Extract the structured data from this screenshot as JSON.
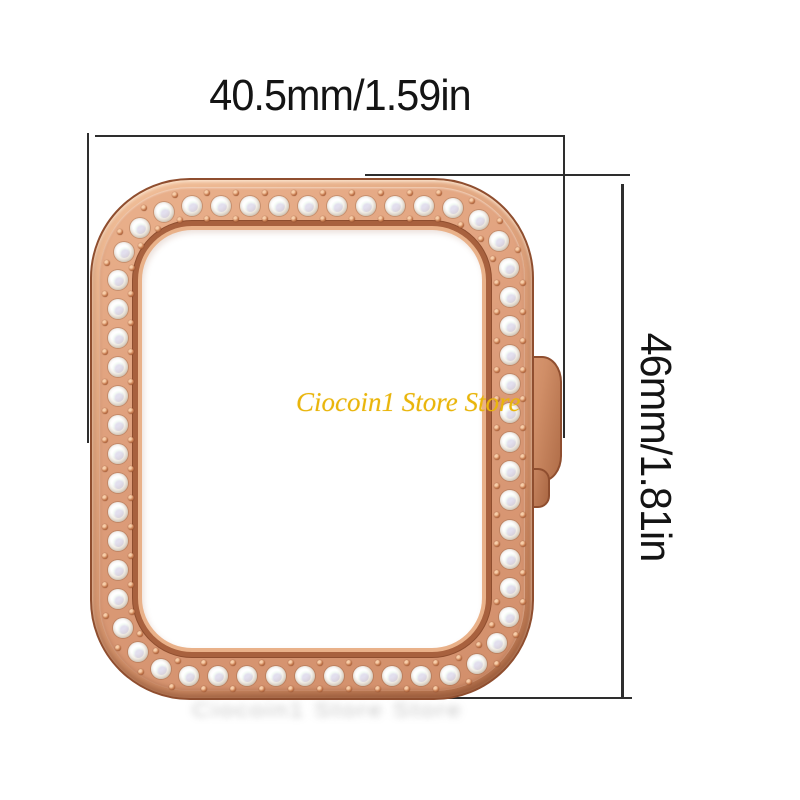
{
  "dimensions": {
    "width_label": "40.5mm/1.59in",
    "height_label": "46mm/1.81in"
  },
  "watermark": {
    "text": "Ciocoin1 Store Store",
    "color": "#e9b50b"
  },
  "watermark_blurred": {
    "text": "Ciocoin1 Store Store"
  },
  "annotation": {
    "line_color": "#2e2e2e"
  },
  "case": {
    "material": "rose-gold",
    "colors": {
      "rose_light": "#f2c09a",
      "rose_mid": "#dd9d7a",
      "rose_dark": "#b06d48",
      "outline": "#8f4e2f"
    },
    "stones": {
      "count": 55,
      "stone_diameter": 20,
      "bead_diameter": 6,
      "bead_offset": 13
    }
  }
}
